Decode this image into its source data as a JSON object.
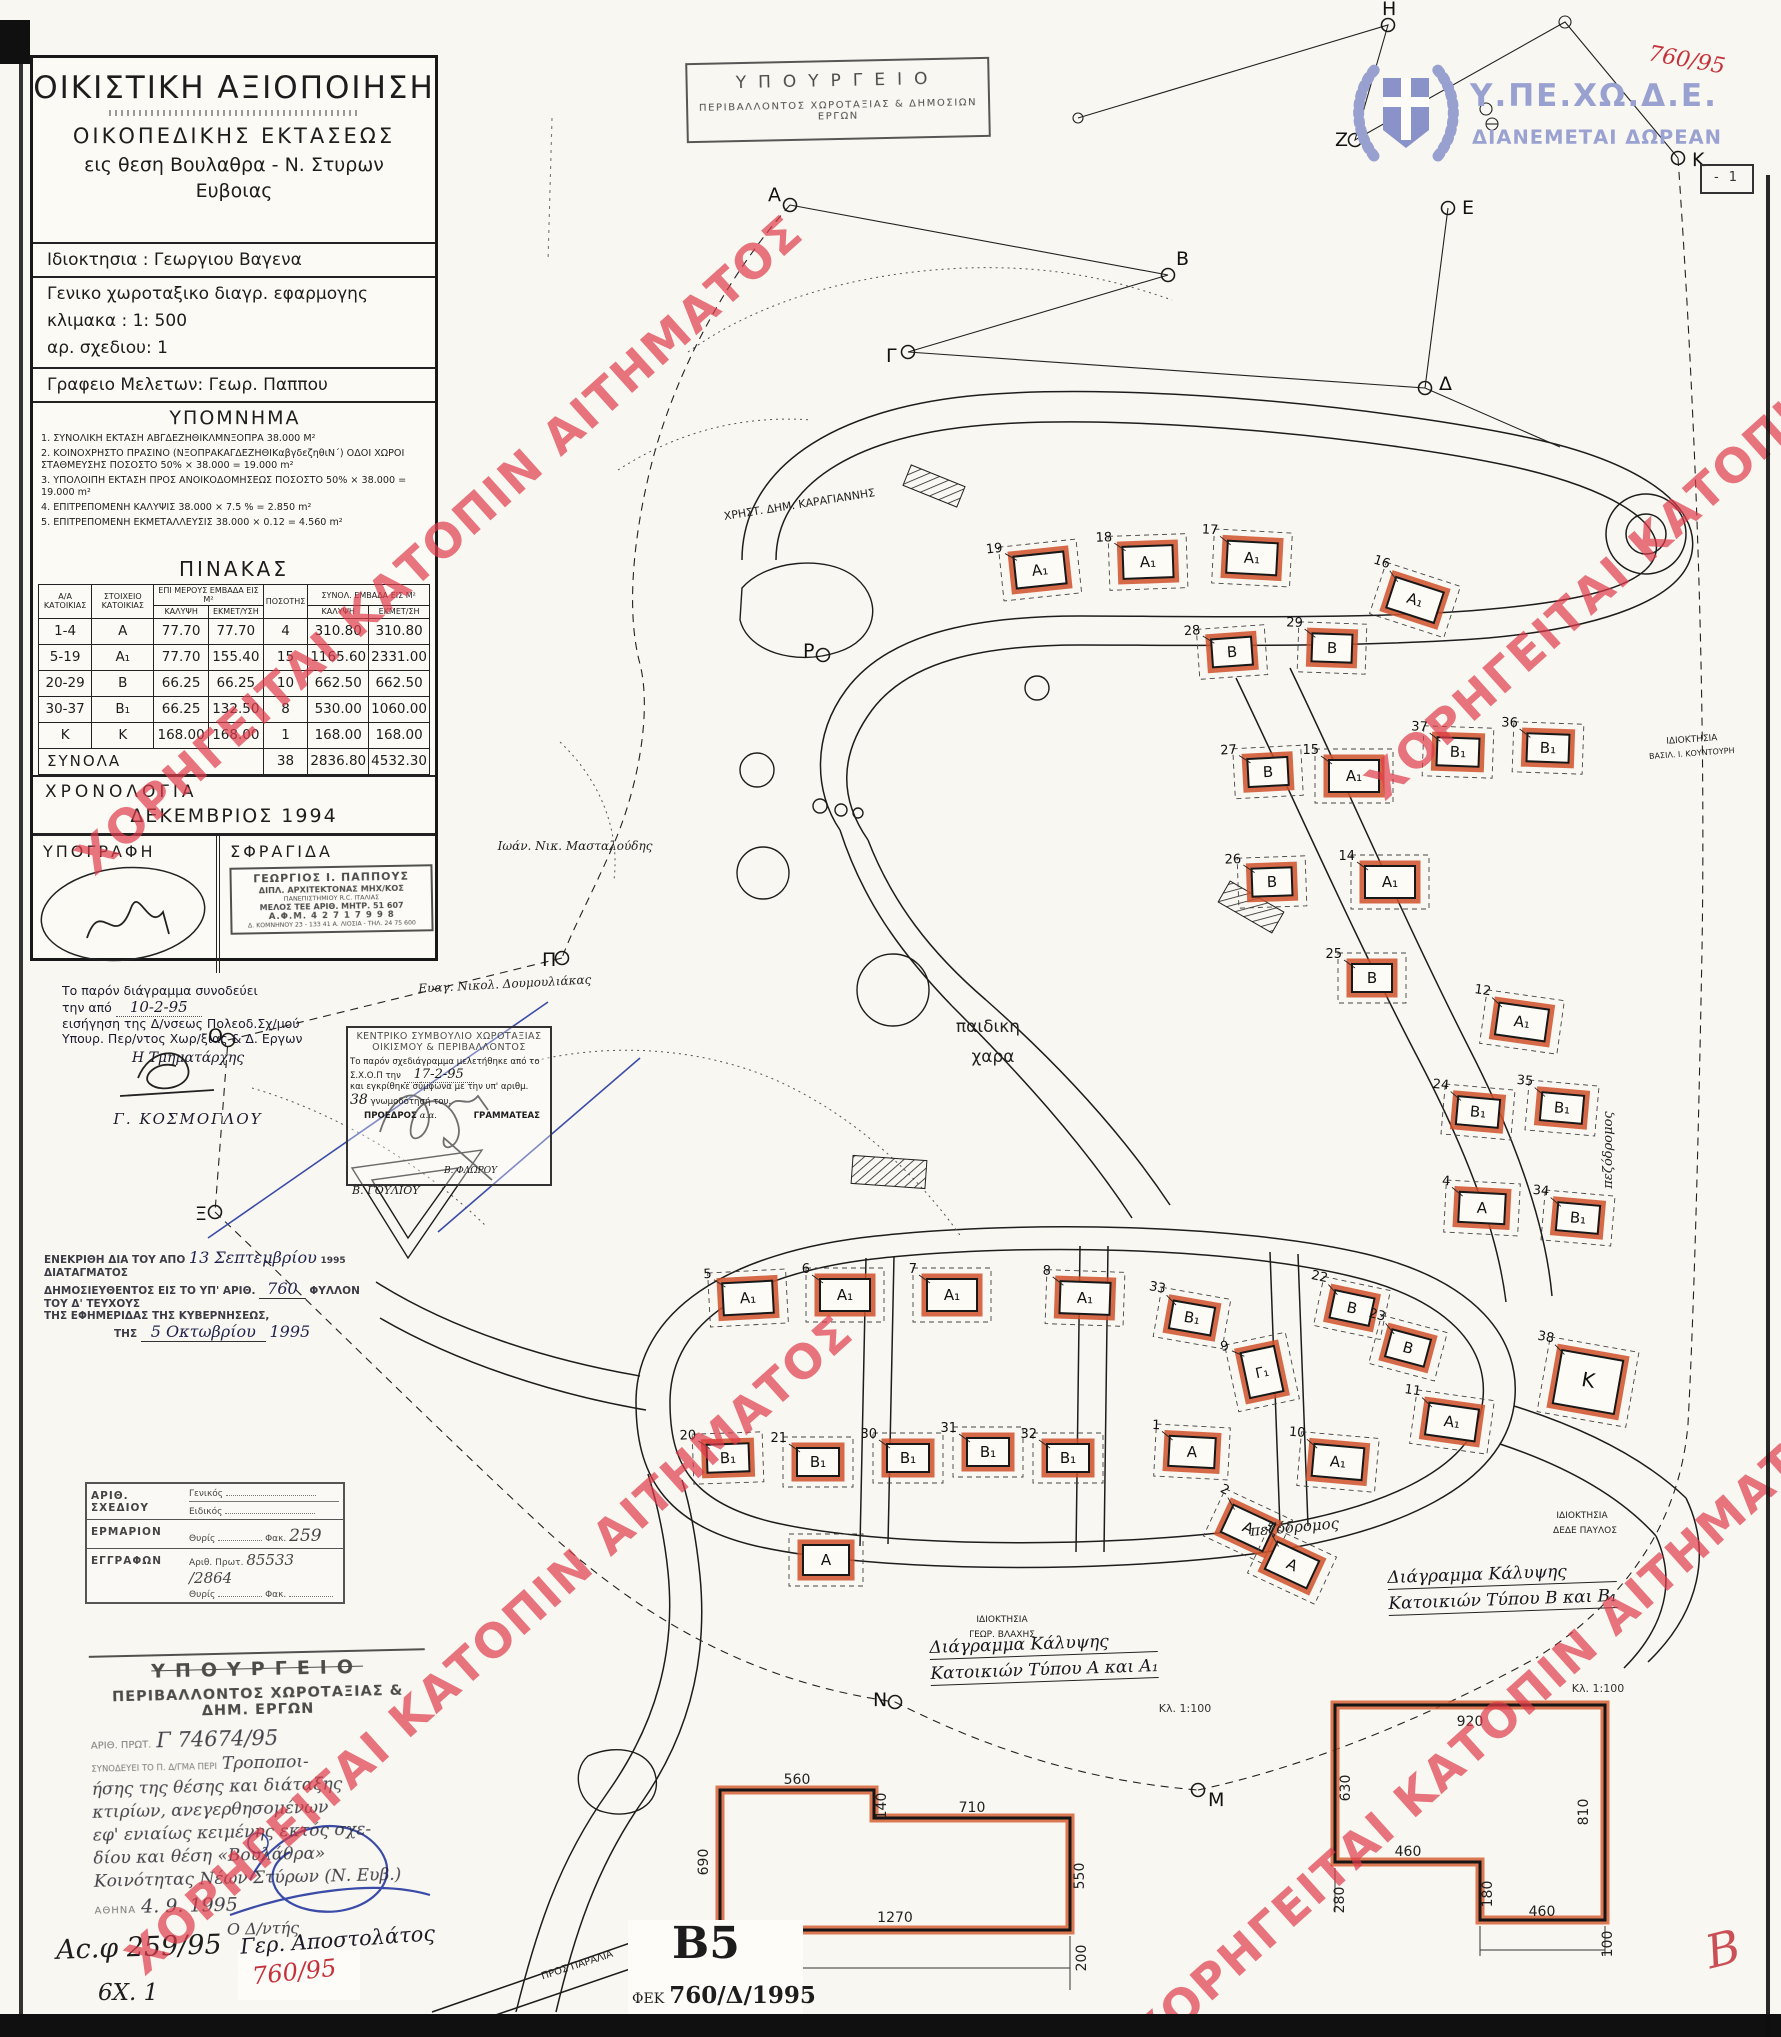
{
  "page": {
    "watermark_text": "ΧΟΡΗΓΕΙΤΑΙ ΚΑΤΟΠΙΝ ΑΙΤΗΜΑΤΟΣ",
    "page_marker": "- 1",
    "sheet_code": "Β5",
    "gazette_prefix": "ΦΕΚ",
    "gazette_ref": "760/Δ/1995",
    "red_ref": "760/95",
    "archive_ref": "Αc.φ 259/95",
    "archive_sub": "6Χ. 1",
    "red_initial": "Β"
  },
  "header_stamps": {
    "ministry_box": {
      "line1": "ΥΠΟΥΡΓΕΙΟ",
      "line2": "ΠΕΡΙΒΑΛΛΟΝΤΟΣ  ΧΩΡΟΤΑΞΙΑΣ  &  ΔΗΜΟΣΙΩΝ  ΕΡΓΩΝ"
    },
    "logo": {
      "acronym": "Υ.ΠΕ.ΧΩ.Δ.Ε.",
      "slogan": "ΔΙΑΝΕΜΕΤΑΙ ΔΩΡΕΑΝ"
    }
  },
  "title_block": {
    "title": "ΟΙΚΙΣΤΙΚΗ   ΑΞΙΟΠΟΙΗΣΗ",
    "sub1": "ΟΙΚΟΠΕΔΙΚΗΣ    ΕΚΤΑΣΕΩΣ",
    "sub2": "εις θεση Βουλαθρα - Ν. Στυρων",
    "sub3": "Ευβοιας",
    "owner": "Ιδιοκτησια :   Γεωργιου Βαγενα",
    "drawing_type": "Γενικο   χωροταξικο διαγρ. εφαρμογης",
    "scale": "κλιμακα : 1: 500",
    "sheet_no": "αρ. σχεδιου:  1",
    "office": "Γραφειο Μελετων:  Γεωρ. Παππου"
  },
  "legend": {
    "title": "ΥΠΟΜΝΗΜΑ",
    "items": [
      "1. ΣΥΝΟΛΙΚΗ ΕΚΤΑΣΗ  ΑΒΓΔΕΖΗΘΙΚΛΜΝΞΟΠΡΑ      38.000 Μ²",
      "2. ΚΟΙΝΟΧΡΗΣΤΟ ΠΡΑΣΙΝΟ (ΝΞΟΠΡΑΚΑΓΔΕΖΗΘΙΚαβγδεζηθιΝ΄) ΟΔΟΙ ΧΩΡΟΙ ΣΤΑΘΜΕΥΣΗΣ ΠΟΣΟΣΤΟ 50% × 38.000 = 19.000 m²",
      "3. ΥΠΟΛΟΙΠΗ ΕΚΤΑΣΗ ΠΡΟΣ ΑΝΟΙΚΟΔΟΜΗΣΕΩΣ  ΠΟΣΟΣΤΟ 50% × 38.000 = 19.000 m²",
      "4. ΕΠΙΤΡΕΠΟΜΕΝΗ ΚΑΛΥΨΙΣ   38.000 × 7.5 %  = 2.850 m²",
      "5. ΕΠΙΤΡΕΠΟΜΕΝΗ ΕΚΜΕΤΑΛΛΕΥΣΙΣ   38.000 × 0.12  =  4.560 m²"
    ]
  },
  "table": {
    "title": "ΠΙΝΑΚΑΣ",
    "col_headers": {
      "aa": "Α/Α ΚΑΤΟΙΚΙΑΣ",
      "element": "ΣΤΟΙΧΕΙΟ ΚΑΤΟΙΚΙΑΣ",
      "partial": "ΕΠΙ ΜΕΡΟΥΣ ΕΜΒΑΔΑ ΕΙΣ Μ²",
      "qty": "ΠΟΣΟΤΗΣ",
      "total": "ΣΥΝΟΛ. ΕΜΒΑΔΑ ΕΙΣ Μ²",
      "cover": "ΚΑΛΥΨΗ",
      "exploit": "ΕΚΜΕΤ/ΥΣΗ",
      "cover2": "ΚΑΛΥΨΗ",
      "exploit2": "ΕΚΜΕΤ/ΣΗ"
    },
    "rows": [
      [
        "1-4",
        "Α",
        "77.70",
        "77.70",
        "4",
        "310.80",
        "310.80"
      ],
      [
        "5-19",
        "Α₁",
        "77.70",
        "155.40",
        "15",
        "1165.60",
        "2331.00"
      ],
      [
        "20-29",
        "Β",
        "66.25",
        "66.25",
        "10",
        "662.50",
        "662.50"
      ],
      [
        "30-37",
        "Β₁",
        "66.25",
        "132.50",
        "8",
        "530.00",
        "1060.00"
      ],
      [
        "Κ",
        "Κ",
        "168.00",
        "168.00",
        "1",
        "168.00",
        "168.00"
      ]
    ],
    "totals": {
      "label": "ΣΥΝΟΛΑ",
      "qty": "38",
      "cover": "2836.80",
      "exploit": "4532.30"
    }
  },
  "chronology": {
    "label": "ΧΡΟΝΟΛΟΓΙΑ",
    "value": "ΔΕΚΕΜΒΡΙΟΣ   1994"
  },
  "signature_block": {
    "sig_label": "ΥΠΟΓΡΑΦΗ",
    "stamp_label": "ΣΦΡΑΓΙΔΑ",
    "stamp_lines": [
      "ΓΕΩΡΓΙΟΣ Ι. ΠΑΠΠΟΥΣ",
      "ΔΙΠΛ. ΑΡΧΙΤΕΚΤΟΝΑΣ ΜΗΧ/ΚΟΣ",
      "ΠΑΝΕΠΙΣΤΗΜΙΟΥ  R.C.  ΙΤΑΛΙΑΣ",
      "ΜΕΛΟΣ ΤΕΕ   ΑΡΙΘ. ΜΗΤΡ. 51 607",
      "Α.Φ.Μ.  4 2 7 1 7 9 9 8",
      "Δ. ΚΟΜΝΗΝΟΥ 23 - 133 41 Α. ΛΙΟΣΙΑ - ΤΗΛ. 24 75 600"
    ]
  },
  "accompany_note": {
    "l1": "Το  παρόν  διάγραμμα  συνοδεύει",
    "l2_pre": "την από",
    "l2_hand": "10-2-95",
    "l3": "εισήγηση της Δ/νσεως Πολεοδ.Σχ/μού",
    "l4": "Υπουρ. Περ/ντος Χωρ/ξίας & Δ. Εργων",
    "l5": "Η Τμηματάρχης",
    "name": "Γ. ΚΟΣΜΟΓΛΟΥ"
  },
  "council_box": {
    "t1": "ΚΕΝΤΡΙΚΟ ΣΥΜΒΟΥΛΙΟ ΧΩΡΟΤΑΞΙΑΣ",
    "t2": "ΟΙΚΙΣΜΟΥ & ΠΕΡΙΒΑΛΛΟΝΤΟΣ",
    "b1": "Το παρόν σχεδιάγραμμα μελετήθηκε από το",
    "b2_pre": "Σ.Χ.Ο.Π  την",
    "b2_hand": "17-2-95",
    "b3": "και εγκρίθηκε σύμφωνα με την υπ' αριθμ.",
    "b4_hand": "38",
    "b4_post": "γνωμοδότησή του.",
    "president": "ΠΡΟΕΔΡΟΣ",
    "aa": "α.α.",
    "secretary": "ΓΡΑΜΜΑΤΕΑΣ",
    "president_name": "Β. ΓΟΥΛΙΟΥ",
    "secretary_name": "Β. ΦΛΩΡΟΥ",
    "side_note": "Ευαγ. Νικολ. Δουμουλιάκας"
  },
  "decree_note": {
    "l1_pre": "ΕΝΕΚΡΙΘΗ ΔΙΑ ΤΟΥ ΑΠΟ",
    "l1_hand": "13 Σεπτεμβρίου",
    "l1_year": "1995",
    "l1_post": "ΔΙΑΤΑΓΜΑΤΟΣ",
    "l2_pre": "ΔΗΜΟΣΙΕΥΘΕΝΤΟΣ ΕΙΣ ΤΟ ΥΠ' ΑΡΙΘ.",
    "l2_hand": "760",
    "l2_post": "ΦΥΛΛΟΝ ΤΟΥ Δ' ΤΕΥΧΟΥΣ",
    "l3": "ΤΗΣ ΕΦΗΜΕΡΙΔΑΣ ΤΗΣ ΚΥΒΕΡΝΗΣΕΩΣ,",
    "l4_pre": "ΤΗΣ",
    "l4_hand": "5 Οκτωβρίου",
    "l4_year": "1995"
  },
  "archive_stamp": {
    "r1_label": "ΑΡΙΘ. ΣΧΕΔΙΟΥ",
    "r1a": "Γενικός",
    "r1b": "Ειδικός",
    "r2_label": "ΕΡΜΑΡΙΟΝ",
    "r2a": "Θυρίς",
    "r2b": "Φακ.",
    "r2b_hand": "259",
    "r3_label": "ΕΓΓΡΑΦΩΝ",
    "r3a": "Αριθ. Πρωτ.",
    "r3a_hand": "85533 /2864",
    "r3b": "Θυρίς",
    "r3c": "Φακ."
  },
  "ministry_stamp": {
    "t1": "ΥΠΟΥΡΓΕΙΟ",
    "t2": "ΠΕΡΙΒΑΛΛΟΝΤΟΣ  ΧΩΡΟΤΑΞΙΑΣ  &  ΔΗΜ.  ΕΡΓΩΝ",
    "prot_label": "ΑΡΙΘ. ΠΡΩΤ.",
    "prot_hand": "Γ 74674/95",
    "ref_label": "ΣΥΝΟΔΕΥΕΙ ΤΟ Π. Δ/ΓΜΑ ΠΕΡΙ",
    "hand_lines": [
      "Τροποποι-",
      "ήσης της θέσης και διάταξης",
      "κτιρίων, ανεγερθησομένων",
      "εφ' ενιαίως κειμένης εκτός σχε-",
      "δίου και θέση «Βουλάθρα»",
      "Κοινότητας Νέων Στύρων (Ν. Ευβ.)"
    ],
    "city_label": "ΑΘΗΝΑ",
    "date_hand": "4. 9. 1995",
    "signer_title": "Ο Δ/ντής",
    "signer_name": "Γερ. Αποστολάτος"
  },
  "plan": {
    "buildings": [
      {
        "t": "Α₁",
        "n": "19",
        "x": 1040,
        "y": 570,
        "r": -6
      },
      {
        "t": "Α₁",
        "n": "18",
        "x": 1148,
        "y": 562,
        "r": -2
      },
      {
        "t": "Α₁",
        "n": "17",
        "x": 1252,
        "y": 558,
        "r": 3
      },
      {
        "t": "Α₁",
        "n": "16",
        "x": 1415,
        "y": 600,
        "r": 18
      },
      {
        "t": "Β",
        "n": "28",
        "x": 1232,
        "y": 652,
        "r": -4
      },
      {
        "t": "Β",
        "n": "29",
        "x": 1332,
        "y": 648,
        "r": 2
      },
      {
        "t": "Β",
        "n": "27",
        "x": 1268,
        "y": 772,
        "r": -3
      },
      {
        "t": "Α₁",
        "n": "15",
        "x": 1354,
        "y": 776,
        "r": 0
      },
      {
        "t": "Β₁",
        "n": "37",
        "x": 1458,
        "y": 752,
        "r": 2
      },
      {
        "t": "Β₁",
        "n": "36",
        "x": 1548,
        "y": 748,
        "r": 2
      },
      {
        "t": "Β",
        "n": "26",
        "x": 1272,
        "y": 882,
        "r": -2
      },
      {
        "t": "Α₁",
        "n": "14",
        "x": 1390,
        "y": 882,
        "r": 0
      },
      {
        "t": "Β",
        "n": "25",
        "x": 1372,
        "y": 978,
        "r": 0
      },
      {
        "t": "Α₁",
        "n": "12",
        "x": 1522,
        "y": 1022,
        "r": 8
      },
      {
        "t": "Β₁",
        "n": "24",
        "x": 1478,
        "y": 1112,
        "r": 5
      },
      {
        "t": "Β₁",
        "n": "35",
        "x": 1562,
        "y": 1108,
        "r": 5
      },
      {
        "t": "Α",
        "n": "4",
        "x": 1482,
        "y": 1208,
        "r": 3
      },
      {
        "t": "Β₁",
        "n": "34",
        "x": 1578,
        "y": 1218,
        "r": 5
      },
      {
        "t": "Α₁",
        "n": "5",
        "x": 748,
        "y": 1298,
        "r": -3
      },
      {
        "t": "Α₁",
        "n": "6",
        "x": 845,
        "y": 1295,
        "r": 0
      },
      {
        "t": "Α₁",
        "n": "7",
        "x": 952,
        "y": 1295,
        "r": 0
      },
      {
        "t": "Α₁",
        "n": "8",
        "x": 1085,
        "y": 1298,
        "r": 2
      },
      {
        "t": "Β₁",
        "n": "33",
        "x": 1192,
        "y": 1318,
        "r": 10
      },
      {
        "t": "Γ₁",
        "n": "9",
        "x": 1262,
        "y": 1372,
        "r": -12
      },
      {
        "t": "Β",
        "n": "22",
        "x": 1352,
        "y": 1308,
        "r": 12
      },
      {
        "t": "Β",
        "n": "23",
        "x": 1408,
        "y": 1348,
        "r": 15
      },
      {
        "t": "Α₁",
        "n": "11",
        "x": 1452,
        "y": 1422,
        "r": 8
      },
      {
        "t": "Κ",
        "n": "38",
        "x": 1588,
        "y": 1382,
        "r": 10
      },
      {
        "t": "Β₁",
        "n": "20",
        "x": 728,
        "y": 1458,
        "r": -2
      },
      {
        "t": "Β₁",
        "n": "21",
        "x": 818,
        "y": 1462,
        "r": 0
      },
      {
        "t": "Β₁",
        "n": "30",
        "x": 908,
        "y": 1458,
        "r": 0
      },
      {
        "t": "Β₁",
        "n": "31",
        "x": 988,
        "y": 1452,
        "r": 0
      },
      {
        "t": "Β₁",
        "n": "32",
        "x": 1068,
        "y": 1458,
        "r": 0
      },
      {
        "t": "Α",
        "n": "1",
        "x": 1192,
        "y": 1452,
        "r": 3
      },
      {
        "t": "Α₁",
        "n": "10",
        "x": 1338,
        "y": 1462,
        "r": 5
      },
      {
        "t": "Α",
        "n": "2",
        "x": 1248,
        "y": 1528,
        "r": 25
      },
      {
        "t": "Α",
        "n": "3",
        "x": 1292,
        "y": 1565,
        "r": 25
      },
      {
        "t": "Α",
        "n": "",
        "x": 826,
        "y": 1560,
        "r": 0
      }
    ],
    "survey_points": [
      {
        "l": "Η",
        "x": 1388,
        "y": 25,
        "dx": -6,
        "dy": -10
      },
      {
        "l": "Ζ",
        "x": 1355,
        "y": 140,
        "dx": -20,
        "dy": 6
      },
      {
        "l": "Ε",
        "x": 1448,
        "y": 208,
        "dx": 14,
        "dy": 6
      },
      {
        "l": "Κ",
        "x": 1678,
        "y": 158,
        "dx": 14,
        "dy": 8
      },
      {
        "l": "Α",
        "x": 790,
        "y": 205,
        "dx": -22,
        "dy": -4
      },
      {
        "l": "Β",
        "x": 1168,
        "y": 275,
        "dx": 8,
        "dy": -10
      },
      {
        "l": "Γ",
        "x": 908,
        "y": 352,
        "dx": -22,
        "dy": 10
      },
      {
        "l": "Δ",
        "x": 1425,
        "y": 388,
        "dx": 14,
        "dy": 2
      },
      {
        "l": "Ρ",
        "x": 823,
        "y": 655,
        "dx": -20,
        "dy": 2
      },
      {
        "l": "Π",
        "x": 562,
        "y": 958,
        "dx": -20,
        "dy": 8
      },
      {
        "l": "Ο",
        "x": 228,
        "y": 1040,
        "dx": -20,
        "dy": 2
      },
      {
        "l": "Ξ",
        "x": 215,
        "y": 1212,
        "dx": -20,
        "dy": 8
      },
      {
        "l": "Ν",
        "x": 895,
        "y": 1702,
        "dx": -22,
        "dy": 4
      },
      {
        "l": "Μ",
        "x": 1198,
        "y": 1790,
        "dx": 10,
        "dy": 16
      }
    ],
    "labels": [
      {
        "t": "ΧΡΗΣΤ. ΔΗΜ. ΚΑΡΑΓΙΑΝΝΗΣ",
        "x": 800,
        "y": 508,
        "r": -9,
        "s": 11
      },
      {
        "t": "Ιωάν. Νικ. Μασταλούδης",
        "x": 575,
        "y": 850,
        "r": 0,
        "s": 12,
        "h": 1
      },
      {
        "t": "Ευαγ. Νικολ. Δουμουλιάκας",
        "x": 505,
        "y": 988,
        "r": -3,
        "s": 12,
        "h": 1
      },
      {
        "t": "παιδικη",
        "x": 988,
        "y": 1032,
        "r": 0,
        "s": 17
      },
      {
        "t": "χαρα",
        "x": 993,
        "y": 1062,
        "r": 0,
        "s": 17
      },
      {
        "t": "πεζόδρομος",
        "x": 1295,
        "y": 1532,
        "r": -5,
        "s": 15,
        "h": 1
      },
      {
        "t": "πεζόδρομος",
        "x": 1612,
        "y": 1150,
        "r": -90,
        "s": 13,
        "h": 1
      },
      {
        "t": "ΙΔΙΟΚΤΗΣΙΑ",
        "x": 1692,
        "y": 742,
        "r": -4,
        "s": 9
      },
      {
        "t": "ΒΑΣΙΛ. Ι. ΚΟΥΝΤΟΥΡΗ",
        "x": 1692,
        "y": 756,
        "r": -4,
        "s": 8
      },
      {
        "t": "ΙΔΙΟΚΤΗΣΙΑ",
        "x": 1002,
        "y": 1622,
        "r": 0,
        "s": 9
      },
      {
        "t": "ΓΕΩΡ. ΒΛΑΧΗΣ",
        "x": 1002,
        "y": 1637,
        "r": 0,
        "s": 9
      },
      {
        "t": "ΙΔΙΟΚΤΗΣΙΑ",
        "x": 1582,
        "y": 1518,
        "r": 0,
        "s": 9
      },
      {
        "t": "ΔΕΔΕ ΠΑΥΛΟΣ",
        "x": 1585,
        "y": 1533,
        "r": 0,
        "s": 9
      },
      {
        "t": "ΠΡΟΣ ΠΑΡΑΛΙΑ",
        "x": 578,
        "y": 1968,
        "r": -18,
        "s": 10
      },
      {
        "t": "ΠΡΟΣ ΣΤΥΡΑ",
        "x": 655,
        "y": 1978,
        "r": -78,
        "s": 9
      }
    ],
    "coverage": {
      "a": {
        "title1": "Διάγραμμα Κάλυψης",
        "title2": "Κατοικιών Τύπου Α και Α₁",
        "scale": "Κλ. 1:100",
        "dims": [
          {
            "t": "560",
            "x": 797,
            "y": 1784
          },
          {
            "t": "140",
            "x": 886,
            "y": 1806,
            "r": -90
          },
          {
            "t": "710",
            "x": 972,
            "y": 1812
          },
          {
            "t": "690",
            "x": 708,
            "y": 1862,
            "r": -90
          },
          {
            "t": "1270",
            "x": 895,
            "y": 1922
          },
          {
            "t": "550",
            "x": 1084,
            "y": 1876,
            "r": -90
          },
          {
            "t": "200",
            "x": 1086,
            "y": 1958,
            "r": -90
          }
        ]
      },
      "b": {
        "title1": "Διάγραμμα Κάλυψης",
        "title2": "Κατοικιών Τύπου Β και Β₁",
        "scale": "Κλ. 1:100",
        "dims": [
          {
            "t": "920",
            "x": 1470,
            "y": 1726
          },
          {
            "t": "630",
            "x": 1350,
            "y": 1788,
            "r": -90
          },
          {
            "t": "810",
            "x": 1588,
            "y": 1812,
            "r": -90
          },
          {
            "t": "460",
            "x": 1408,
            "y": 1856
          },
          {
            "t": "280",
            "x": 1344,
            "y": 1900,
            "r": -90
          },
          {
            "t": "180",
            "x": 1492,
            "y": 1894,
            "r": -90
          },
          {
            "t": "460",
            "x": 1542,
            "y": 1916
          },
          {
            "t": "100",
            "x": 1612,
            "y": 1944,
            "r": -90
          }
        ]
      }
    }
  }
}
